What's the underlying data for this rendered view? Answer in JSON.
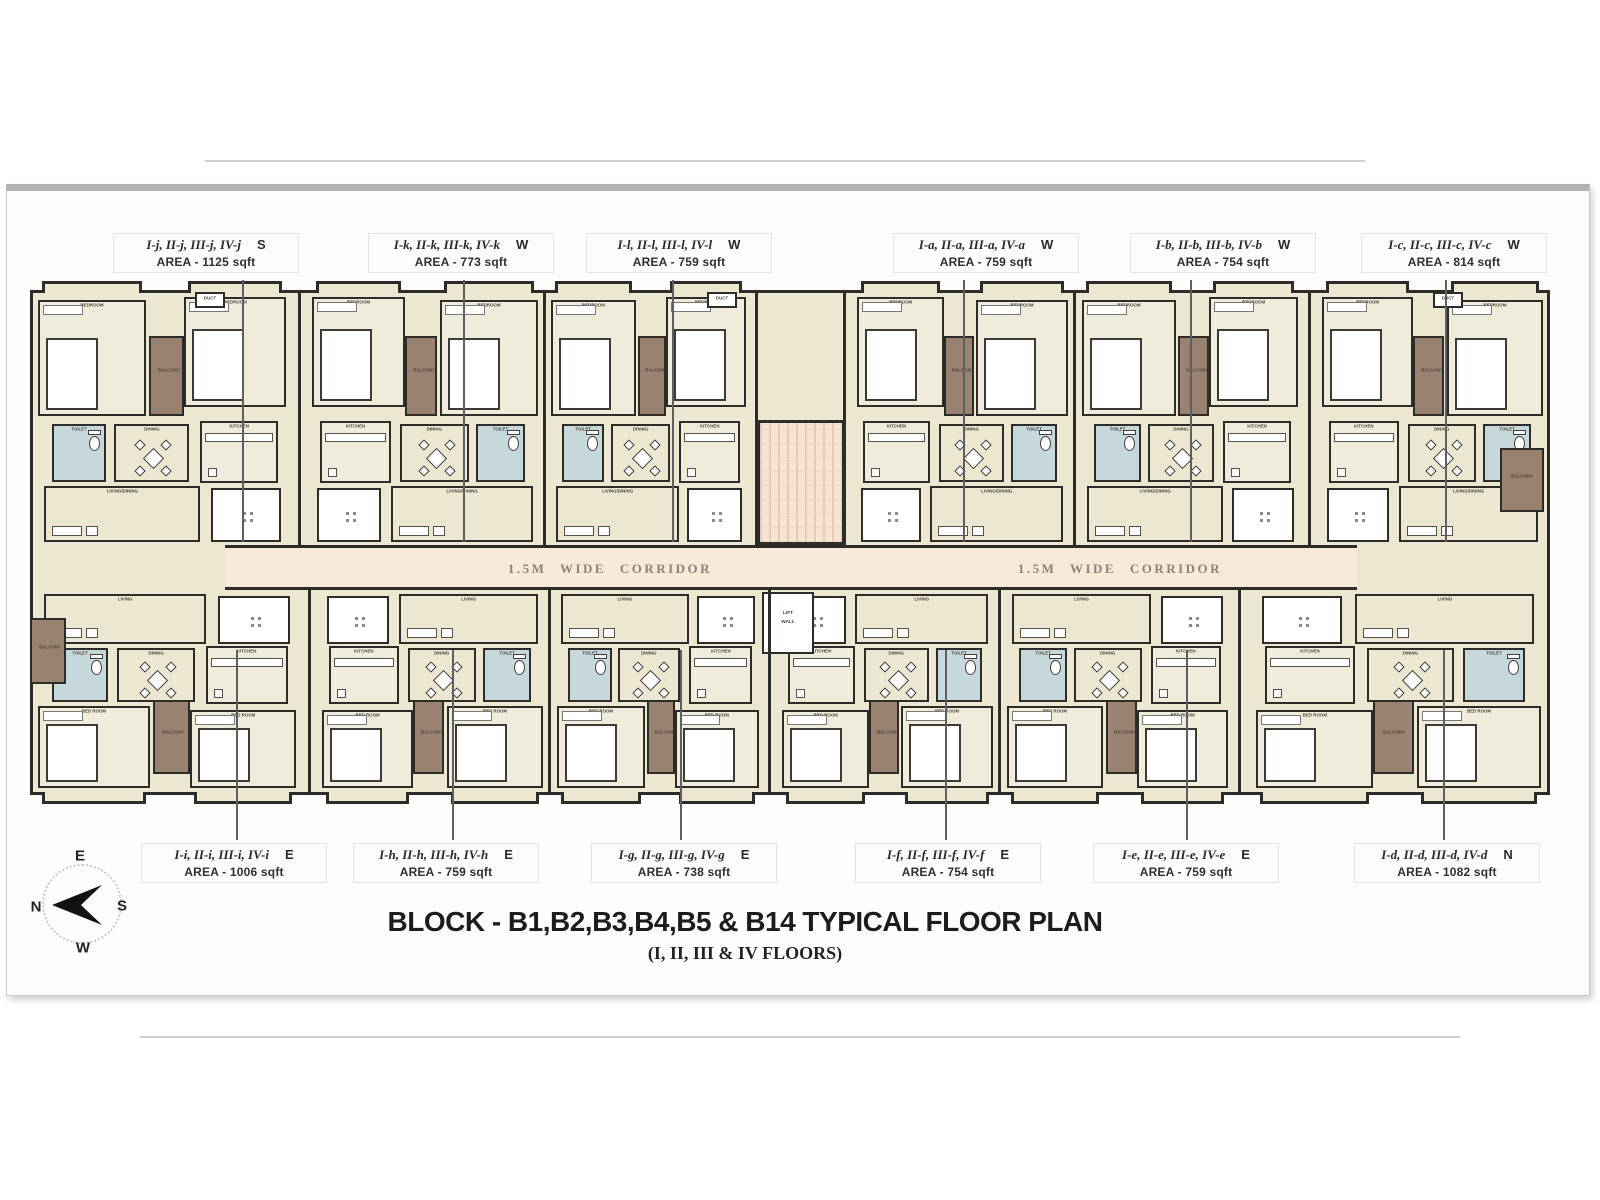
{
  "title": {
    "main": "BLOCK - B1,B2,B3,B4,B5 & B14 TYPICAL FLOOR PLAN",
    "sub": "(I, II, III & IV FLOORS)"
  },
  "corridor": {
    "label": "1.5M WIDE CORRIDOR"
  },
  "compass": {
    "top": "E",
    "left": "N",
    "right": "S",
    "bottom": "W"
  },
  "lift": {
    "line1": "LIFT",
    "line2": "WALL"
  },
  "room_labels": {
    "bedroom": "BEDROOM",
    "bed_room": "BED ROOM",
    "toilet": "TOILET",
    "kitchen": "KITCHEN",
    "living": "LIVING",
    "dining": "DINING",
    "living_dining": "LIVING/DINING",
    "balcony": "BALCONY",
    "duct": "DUCT"
  },
  "colors": {
    "wall": "#2e2c29",
    "room_cream": "#ebe7d1",
    "room_cream_light": "#f0ecdb",
    "room_white": "#ffffff",
    "toilet_blue": "#c6d8dc",
    "balcony_brown": "#9a8271",
    "corridor_fill": "#f7ead8",
    "stair_fill": "#f8e3d0",
    "panel_border": "#b2b2b2"
  },
  "units_top": [
    {
      "code": "I-j, II-j, III-j, IV-j",
      "facing": "S",
      "area": "AREA - 1125 sqft"
    },
    {
      "code": "I-k, II-k, III-k, IV-k",
      "facing": "W",
      "area": "AREA - 773 sqft"
    },
    {
      "code": "I-l, II-l, III-l, IV-l",
      "facing": "W",
      "area": "AREA - 759 sqft"
    },
    {
      "code": "I-a, II-a, III-a, IV-a",
      "facing": "W",
      "area": "AREA - 759 sqft"
    },
    {
      "code": "I-b, II-b, III-b, IV-b",
      "facing": "W",
      "area": "AREA - 754 sqft"
    },
    {
      "code": "I-c, II-c, III-c, IV-c",
      "facing": "W",
      "area": "AREA - 814 sqft"
    }
  ],
  "units_bottom": [
    {
      "code": "I-i, II-i, III-i, IV-i",
      "facing": "E",
      "area": "AREA - 1006 sqft"
    },
    {
      "code": "I-h, II-h, III-h, IV-h",
      "facing": "E",
      "area": "AREA - 759 sqft"
    },
    {
      "code": "I-g, II-g, III-g, IV-g",
      "facing": "E",
      "area": "AREA - 738 sqft"
    },
    {
      "code": "I-f, II-f, III-f, IV-f",
      "facing": "E",
      "area": "AREA - 754 sqft"
    },
    {
      "code": "I-e, II-e, III-e, IV-e",
      "facing": "E",
      "area": "AREA - 759 sqft"
    },
    {
      "code": "I-d, II-d, III-d, IV-d",
      "facing": "N",
      "area": "AREA - 1082 sqft"
    }
  ]
}
